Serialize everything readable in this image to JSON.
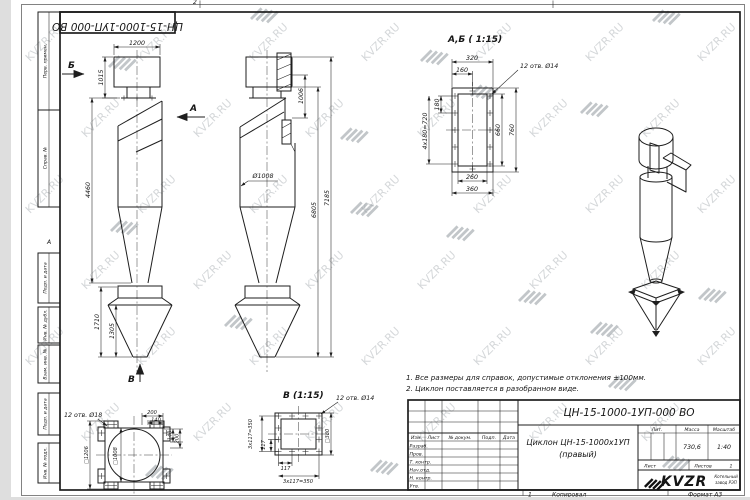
{
  "watermark": {
    "text": "KVZR.RU"
  },
  "frame": {
    "stamp_labels": [
      "Перв. примен.",
      "Справ. №",
      "Подп. и дата",
      "Инв. № дубл.",
      "Взам. инв. №",
      "Подп. и дата",
      "Инв. № подл."
    ],
    "zone_top": "2",
    "zone_left": "А"
  },
  "views": {
    "front": {
      "arrow_b": "Б",
      "arrow_a": "А",
      "arrow_v": "В",
      "dim_1200": "1200",
      "dim_1015": "1015",
      "dim_4460": "4460",
      "dim_1710": "1710",
      "dim_1305": "1305"
    },
    "side": {
      "dim_1006": "1006",
      "dim_d1008": "Ø1008",
      "dim_6805": "6805",
      "dim_7185": "7185"
    },
    "detail_ab": {
      "title": "А,Б ( 1:15)",
      "holes": "12 отв. Ø14",
      "dim_320": "320",
      "dim_160": "160",
      "dim_180": "180",
      "dim_4x180": "4x180=720",
      "dim_660": "660",
      "dim_760": "760",
      "dim_260": "260",
      "dim_360": "360"
    },
    "detail_b": {
      "title": "В (1:15)",
      "holes18": "12 отв. Ø18",
      "dim_200": "200",
      "dim_140": "140",
      "dim_v140": "140",
      "dim_v200": "200",
      "dim_sq1206": "□1206",
      "dim_sq1008": "□1008",
      "holes14": "12 отв. Ø14",
      "dim_sq380": "□380",
      "dim_117_left": "117",
      "dim_3x117_left": "3x117=350",
      "dim_117_bottom": "117",
      "dim_3x117_bottom": "3x117=350"
    }
  },
  "notes": {
    "line1": "1. Все размеры для справок, допустимые отклонения ±100мм.",
    "line2": "2. Циклон поставляется в разобранном виде."
  },
  "title_block": {
    "designation": "ЦН-15-1000-1УП-000 ВО",
    "name_line1": "Циклон ЦН-15-1000х1УП",
    "name_line2": "(правый)",
    "col_izm": "Изм.",
    "col_list": "Лист",
    "col_ndoc": "№ докум.",
    "col_podp": "Подп.",
    "col_data": "Дата",
    "rows": [
      "Разраб.",
      "Пров.",
      "Т. контр.",
      "Нач.отд.",
      "Н. контр.",
      "Утв."
    ],
    "lit_label": "Лит.",
    "mass_label": "Масса",
    "scale_label": "Масштаб",
    "mass_value": "730,6",
    "scale_value": "1:40",
    "sheet_label": "Лист",
    "sheets_label": "Листов",
    "sheets_value": "1",
    "logo_text": "KVZR",
    "logo_caption1": "Котельный",
    "logo_caption2": "завод РЭП"
  },
  "footer": {
    "num": "1",
    "copied": "Копировал",
    "format": "Формат А3"
  }
}
